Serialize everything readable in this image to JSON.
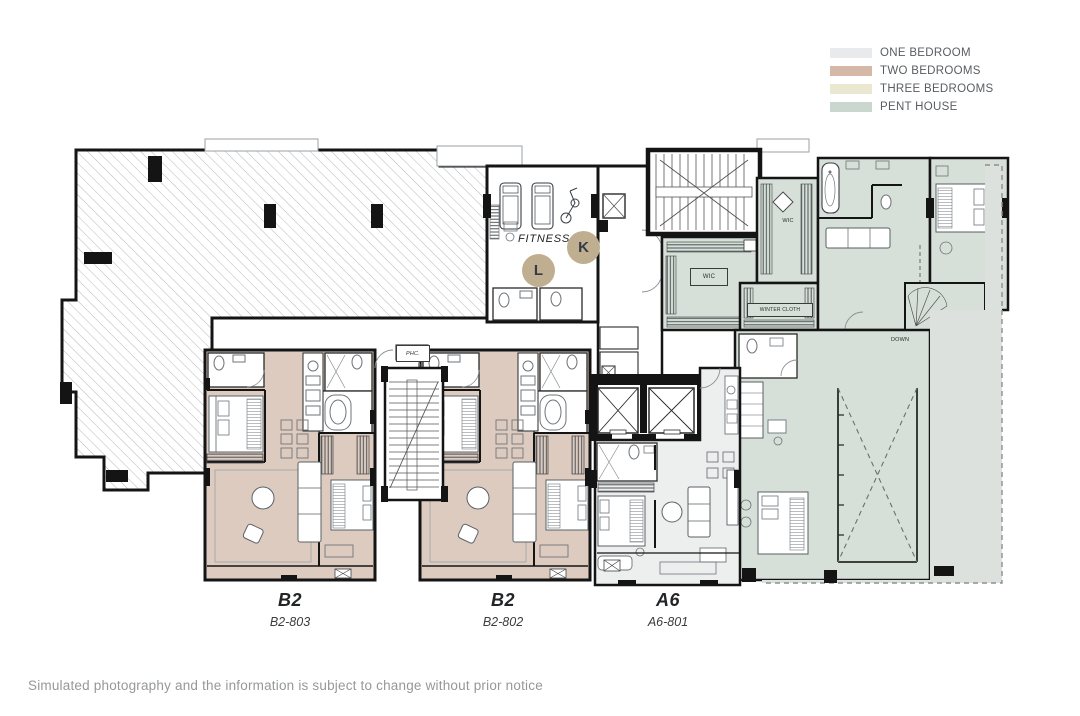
{
  "legend": {
    "items": [
      {
        "label": "ONE BEDROOM",
        "color": "#e8eaeb"
      },
      {
        "label": "TWO BEDROOMS",
        "color": "#d5b8a8"
      },
      {
        "label": "THREE BEDROOMS",
        "color": "#ebe8d2"
      },
      {
        "label": "PENT HOUSE",
        "color": "#cad7cf"
      }
    ]
  },
  "plan": {
    "fitness_label": "FITNESS",
    "markers": {
      "k": "K",
      "l": "L"
    },
    "marker_color": "#c0ae90",
    "room_labels": {
      "wic_a": "WIC",
      "wic_b": "WIC",
      "winter_cloth": "WINTER CLOTH",
      "down": "DOWN",
      "phc": "PHC."
    },
    "fills": {
      "one_bedroom_unit": "#ecefee",
      "two_bedroom_unit": "#ddcbc0",
      "penthouse": "#d6dfd8",
      "terrace": "#dce1dd",
      "wall": "#141414"
    }
  },
  "units": [
    {
      "type": "B2",
      "number": "B2-803"
    },
    {
      "type": "B2",
      "number": "B2-802"
    },
    {
      "type": "A6",
      "number": "A6-801"
    }
  ],
  "footer": {
    "disclaimer": "Simulated photography and the information is subject to change without prior notice"
  }
}
